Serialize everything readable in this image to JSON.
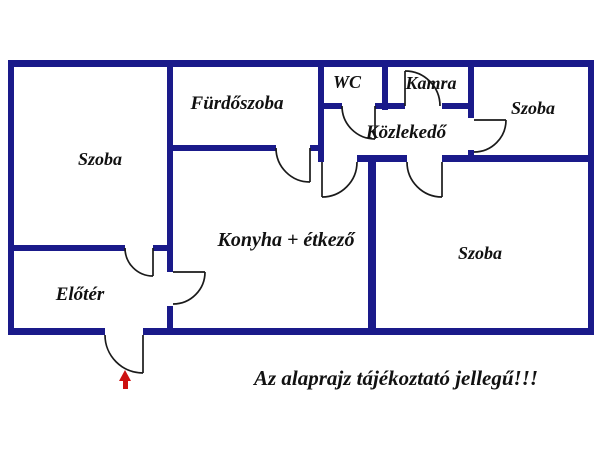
{
  "floor_plan": {
    "rooms": [
      {
        "id": "szoba-left",
        "label": "Szoba"
      },
      {
        "id": "furdoszoba",
        "label": "Fürdőszoba"
      },
      {
        "id": "wc",
        "label": "WC"
      },
      {
        "id": "kamra",
        "label": "Kamra"
      },
      {
        "id": "kozlekedo",
        "label": "Közlekedő"
      },
      {
        "id": "szoba-top-right",
        "label": "Szoba"
      },
      {
        "id": "konyha-etkezo",
        "label": "Konyha + étkező"
      },
      {
        "id": "eloter",
        "label": "Előtér"
      },
      {
        "id": "szoba-bottom-right",
        "label": "Szoba"
      }
    ],
    "disclaimer": "Az alaprajz tájékoztató jellegű!!!",
    "entrance_marker": "red-up-arrow"
  },
  "colors": {
    "wall": "#1a1a8a",
    "door_line": "#1a1a1a",
    "label_text": "#111111",
    "disclaimer_text": "#111111",
    "entrance_arrow": "#cc1111",
    "background": "#ffffff"
  }
}
